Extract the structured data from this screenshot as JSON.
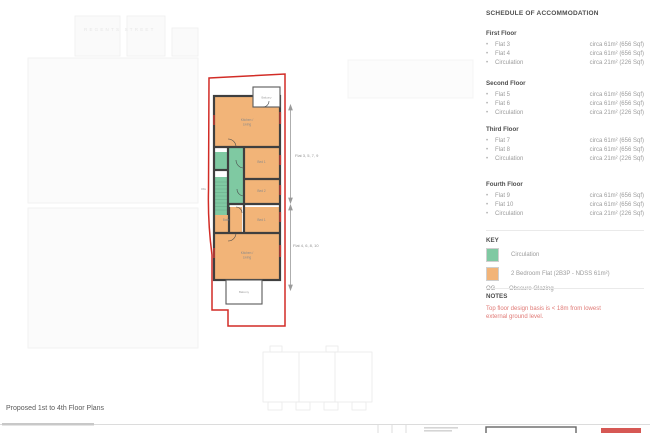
{
  "document": {
    "title": "Proposed 1st to 4th Floor Plans",
    "street_label": "REGENTS STREET"
  },
  "schedule": {
    "title": "SCHEDULE OF ACCOMMODATION",
    "floors": [
      {
        "name": "First Floor",
        "items": [
          {
            "label": "Flat 3",
            "value": "circa 61m² (656 Sqf)"
          },
          {
            "label": "Flat 4",
            "value": "circa 61m² (656 Sqf)"
          },
          {
            "label": "Circulation",
            "value": "circa 21m² (226 Sqf)"
          }
        ]
      },
      {
        "name": "Second Floor",
        "items": [
          {
            "label": "Flat 5",
            "value": "circa 61m² (656 Sqf)"
          },
          {
            "label": "Flat 6",
            "value": "circa 61m² (656 Sqf)"
          },
          {
            "label": "Circulation",
            "value": "circa 21m² (226 Sqf)"
          }
        ]
      },
      {
        "name": "Third Floor",
        "items": [
          {
            "label": "Flat 7",
            "value": "circa 61m² (656 Sqf)"
          },
          {
            "label": "Flat 8",
            "value": "circa 61m² (656 Sqf)"
          },
          {
            "label": "Circulation",
            "value": "circa 21m² (226 Sqf)"
          }
        ]
      },
      {
        "name": "Fourth Floor",
        "items": [
          {
            "label": "Flat 9",
            "value": "circa 61m² (656 Sqf)"
          },
          {
            "label": "Flat 10",
            "value": "circa 61m² (656 Sqf)"
          },
          {
            "label": "Circulation",
            "value": "circa 21m² (226 Sqf)"
          }
        ]
      }
    ]
  },
  "key": {
    "title": "KEY",
    "items": [
      {
        "label": "Circulation"
      },
      {
        "label": "2 Bedroom Flat (2B3P - NDSS 61m²)"
      },
      {
        "abbr": "OG",
        "label": "Obscure Glazing"
      }
    ]
  },
  "notes": {
    "title": "NOTES",
    "body": "Top floor design basis is < 18m from lowest external ground level."
  },
  "plan": {
    "group_top": "Flat 3, 5, 7, 9",
    "group_bottom": "Flat 4, 6, 8, 10",
    "labels": {
      "kitchen_line1": "Kitchen /",
      "kitchen_line2": "Living",
      "balcony": "Balcony",
      "bed1": "Bed 1",
      "bed2": "Bed 2",
      "bath": "Bath",
      "og": "OG"
    }
  },
  "colors": {
    "circulation": "#7FC9A2",
    "flat": "#F2B478",
    "boundary": "#D22C26",
    "wall": "#3f3f3f",
    "notes_red": "#E07A76"
  }
}
